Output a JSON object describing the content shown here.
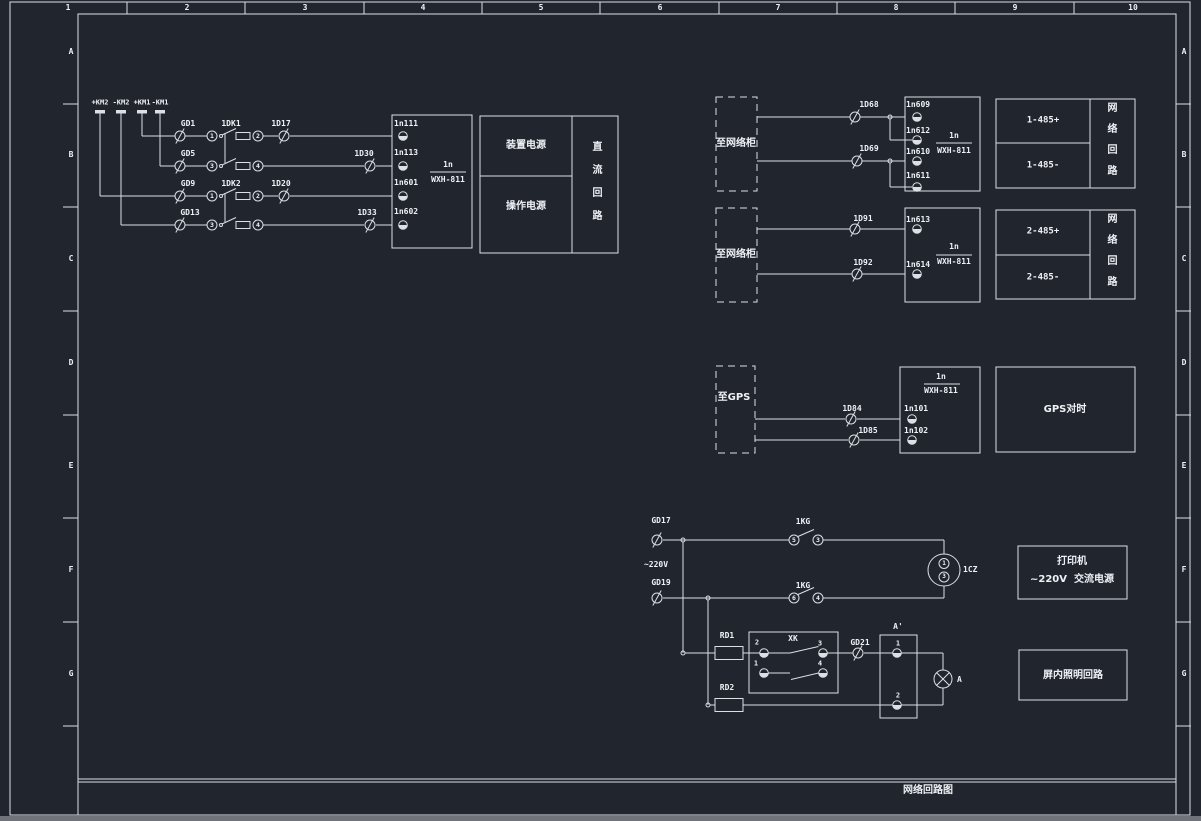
{
  "frame": {
    "cols": [
      "1",
      "2",
      "3",
      "4",
      "5",
      "6",
      "7",
      "8",
      "9",
      "10"
    ],
    "rows": [
      "A",
      "B",
      "C",
      "D",
      "E",
      "F",
      "G"
    ],
    "title": "网络回路图"
  },
  "dc": {
    "bus": [
      "+KM2",
      "-KM2",
      "+KM1",
      "-KM1"
    ],
    "rows": [
      {
        "gd": "GD1",
        "a": "1",
        "sw": "1DK1",
        "b": "2",
        "d": "1D17",
        "term": "1n111"
      },
      {
        "gd": "GD5",
        "a": "3",
        "b": "4",
        "d": "1D30",
        "term": "1n113"
      },
      {
        "gd": "GD9",
        "a": "1",
        "sw": "1DK2",
        "b": "2",
        "d": "1D20",
        "term": "1n601"
      },
      {
        "gd": "GD13",
        "a": "3",
        "b": "4",
        "d": "1D33",
        "term": "1n602"
      }
    ],
    "device": "1n",
    "model": "WXH-811",
    "power": {
      "top": "装置电源",
      "bottom": "操作电源",
      "side": "直流回路"
    }
  },
  "net1": {
    "dest": "至网络柜",
    "d1": "1D68",
    "d2": "1D69",
    "t1": "1n609",
    "t2": "1n612",
    "t3": "1n610",
    "t4": "1n611",
    "device": "1n",
    "model": "WXH-811",
    "out1": "1-485+",
    "out2": "1-485-",
    "side": "网络回路"
  },
  "net2": {
    "dest": "至网络柜",
    "d1": "1D91",
    "d2": "1D92",
    "t1": "1n613",
    "t2": "1n614",
    "device": "1n",
    "model": "WXH-811",
    "out1": "2-485+",
    "out2": "2-485-",
    "side": "网络回路"
  },
  "gps": {
    "dest": "至GPS",
    "d1": "1D84",
    "d2": "1D85",
    "t1": "1n101",
    "t2": "1n102",
    "device": "1n",
    "model": "WXH-811",
    "out": "GPS对时"
  },
  "ac": {
    "gd1": "GD17",
    "volt": "~220V",
    "gd2": "GD19",
    "sw1": "1KG",
    "sw1a": "5",
    "sw1b": "3",
    "sw2": "1KG",
    "sw2a": "6",
    "sw2b": "4",
    "socket": "1CZ",
    "sk1": "1",
    "sk2": "3",
    "printer1": "打印机",
    "printer2": "~220V  交流电源"
  },
  "light": {
    "rd1": "RD1",
    "rd2": "RD2",
    "xk": "XK",
    "x1": "2",
    "x2": "3",
    "x3": "1",
    "x4": "4",
    "gd": "GD21",
    "blk": "A'",
    "b1": "1",
    "b2": "2",
    "lamp": "A",
    "box": "屏内照明回路"
  }
}
